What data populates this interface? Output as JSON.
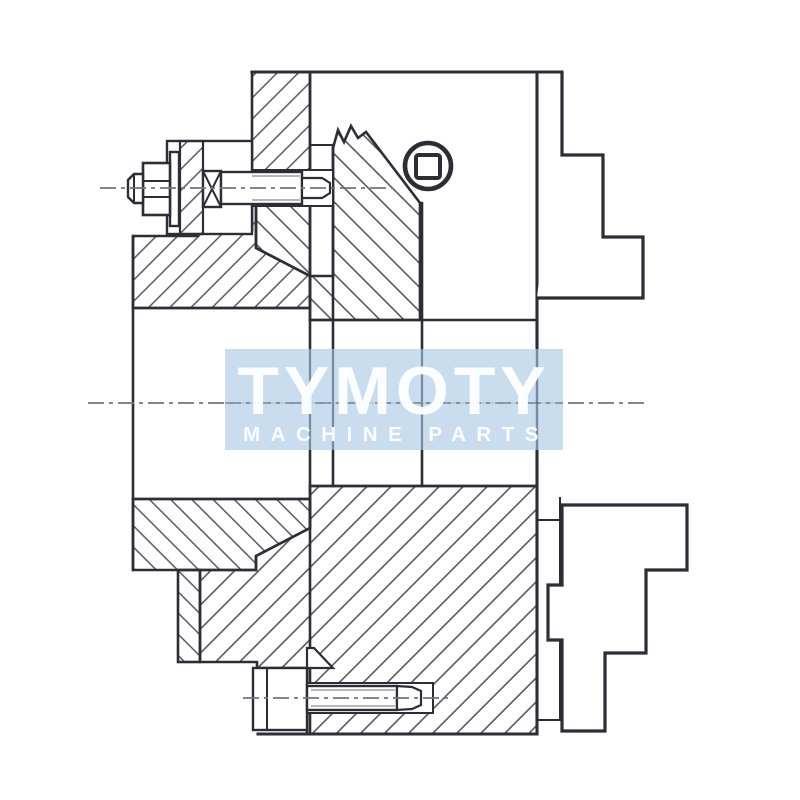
{
  "watermark": {
    "title": "TYMOTY",
    "subtitle": "MACHINE PARTS"
  },
  "colors": {
    "line": "#2d2d38",
    "hatch": "#4b4b57",
    "centerline": "#70757c",
    "watermark_bg": "#c0d7eb",
    "watermark_text": "#ffffff",
    "background": "#ffffff"
  }
}
